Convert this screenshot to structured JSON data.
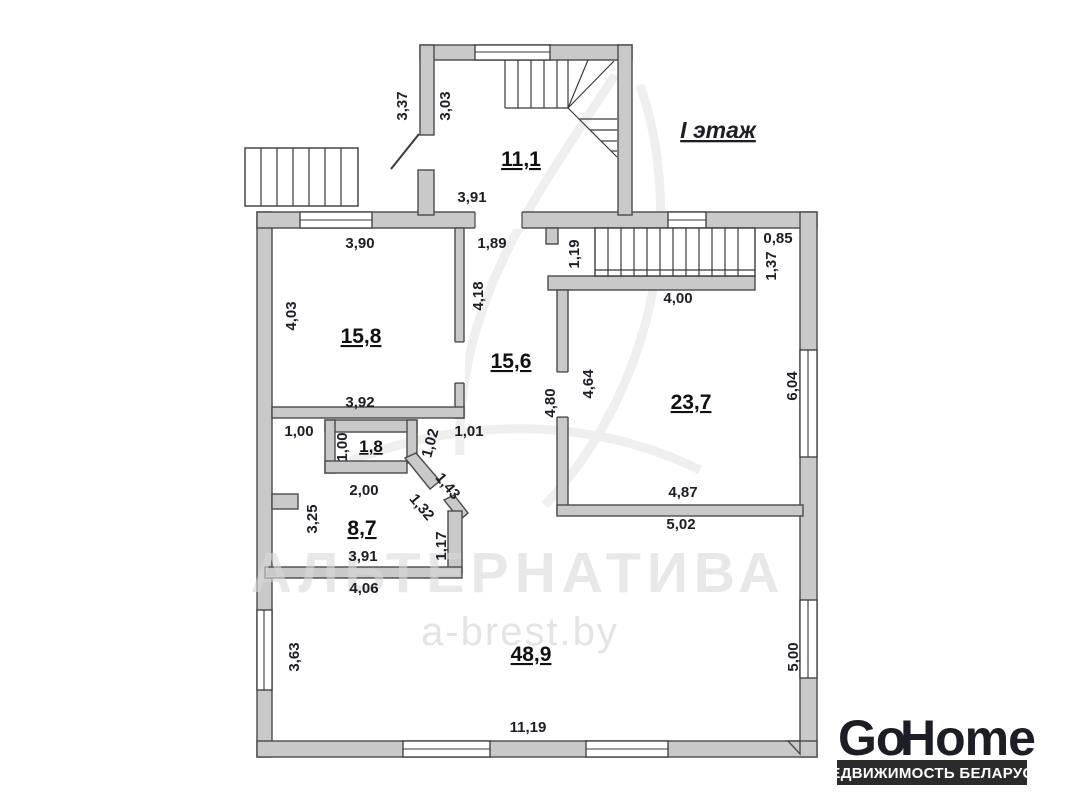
{
  "title": "I этаж",
  "watermark": {
    "brand": "АЛЬТЕРНАТИВА",
    "site": "a-brest.by"
  },
  "logo": {
    "go": "Go",
    "home": "Home",
    "tagline": "НЕДВИЖИМОСТЬ БЕЛАРУСИ"
  },
  "colors": {
    "accent_red": "#c23b3d",
    "logo_dark": "#383838",
    "bar_dark": "#2b2b2b",
    "wall_fill": "#c9c9c9",
    "wall_stroke": "#4a4a4a"
  },
  "rooms": [
    {
      "name": "entry-hall",
      "area": "11,1"
    },
    {
      "name": "room-top-left",
      "area": "15,8"
    },
    {
      "name": "center-hall",
      "area": "15,6"
    },
    {
      "name": "room-right",
      "area": "23,7"
    },
    {
      "name": "closet",
      "area": "1,8"
    },
    {
      "name": "room-mid-left",
      "area": "8,7"
    },
    {
      "name": "living-room",
      "area": "48,9"
    }
  ],
  "dimensions": [
    {
      "value": "3,37"
    },
    {
      "value": "3,03"
    },
    {
      "value": "3,91"
    },
    {
      "value": "1,89"
    },
    {
      "value": "3,90"
    },
    {
      "value": "4,03"
    },
    {
      "value": "4,18"
    },
    {
      "value": "3,92"
    },
    {
      "value": "1,19"
    },
    {
      "value": "4,00"
    },
    {
      "value": "0,85"
    },
    {
      "value": "1,37"
    },
    {
      "value": "4,80"
    },
    {
      "value": "4,64"
    },
    {
      "value": "6,04"
    },
    {
      "value": "4,87"
    },
    {
      "value": "5,02"
    },
    {
      "value": "1,00"
    },
    {
      "value": "1,00"
    },
    {
      "value": "1,02"
    },
    {
      "value": "1,01"
    },
    {
      "value": "1,43"
    },
    {
      "value": "1,32"
    },
    {
      "value": "2,00"
    },
    {
      "value": "3,25"
    },
    {
      "value": "3,91"
    },
    {
      "value": "1,17"
    },
    {
      "value": "4,06"
    },
    {
      "value": "3,63"
    },
    {
      "value": "5,00"
    },
    {
      "value": "11,19"
    }
  ]
}
